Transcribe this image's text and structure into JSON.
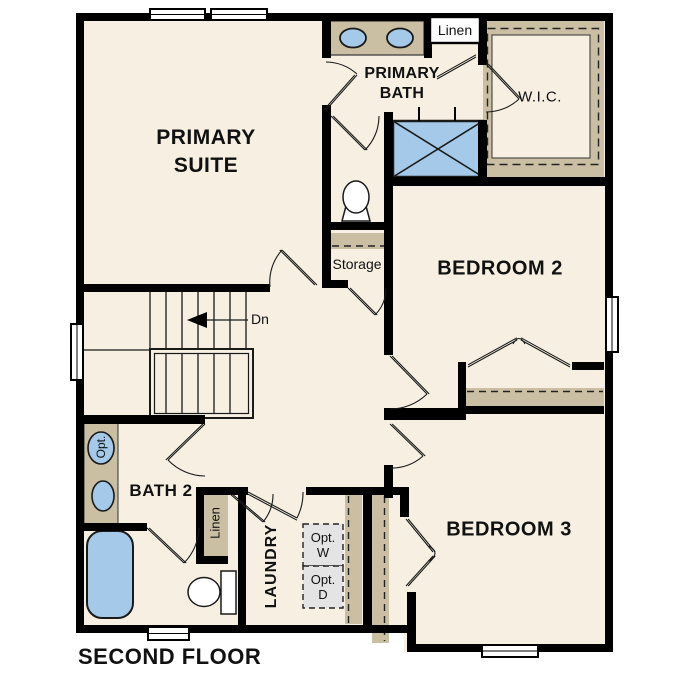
{
  "title": "SECOND FLOOR",
  "colors": {
    "floor_fill": "#F6EFE2",
    "counter_tan": "#CBBFA3",
    "fixture_blue": "#A5C9E9",
    "wall_black": "#000000",
    "optional_gray": "#E4E4E4"
  },
  "rooms": {
    "primary_suite": {
      "line1": "PRIMARY",
      "line2": "SUITE"
    },
    "primary_bath": {
      "line1": "PRIMARY",
      "line2": "BATH"
    },
    "wic": {
      "label": "W.I.C."
    },
    "bedroom2": {
      "label": "BEDROOM 2"
    },
    "bedroom3": {
      "label": "BEDROOM 3"
    },
    "bath2": {
      "label": "BATH 2",
      "optional_sink": "Opt."
    },
    "laundry": {
      "label": "LAUNDRY",
      "optional_washer_line1": "Opt.",
      "optional_washer_line2": "W",
      "optional_dryer_line1": "Opt.",
      "optional_dryer_line2": "D"
    },
    "storage": {
      "label": "Storage"
    },
    "linen_upper": {
      "label": "Linen"
    },
    "linen_lower": {
      "label": "Linen"
    },
    "stairs": {
      "direction_label": "Dn"
    }
  }
}
